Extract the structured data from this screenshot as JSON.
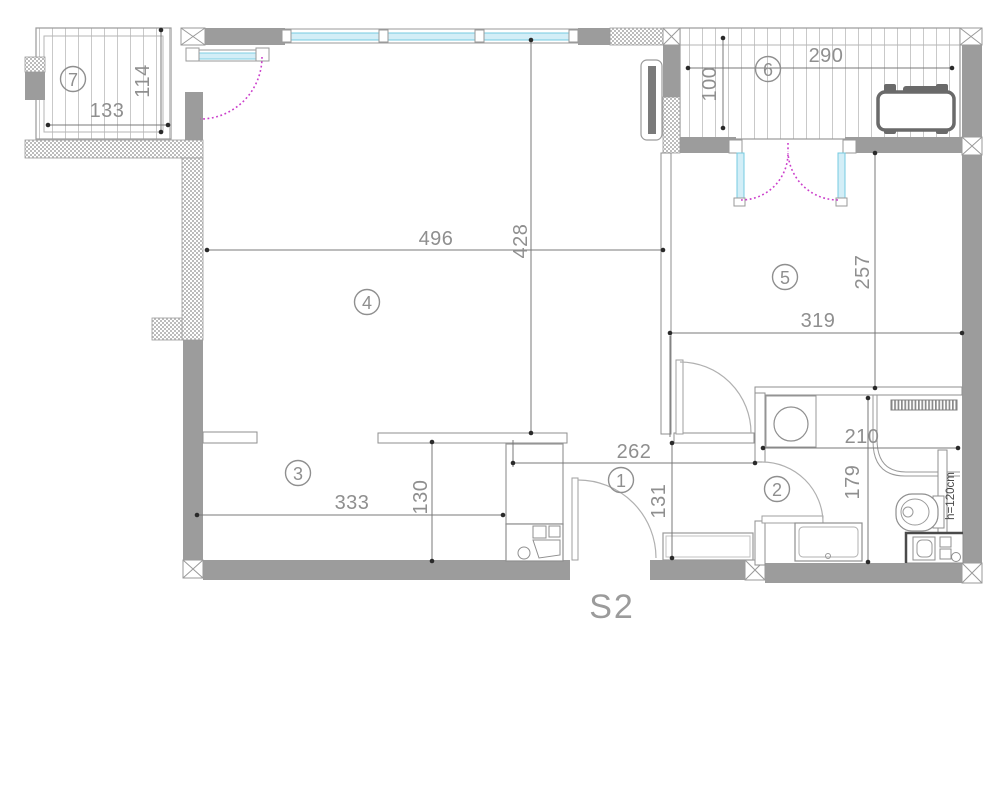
{
  "plan": {
    "title": "S2",
    "rooms": [
      {
        "label": "1"
      },
      {
        "label": "2"
      },
      {
        "label": "3"
      },
      {
        "label": "4"
      },
      {
        "label": "5"
      },
      {
        "label": "6"
      },
      {
        "label": "7"
      }
    ],
    "dimensions": {
      "balcony_left_width": "133",
      "balcony_left_depth": "114",
      "living_width": "496",
      "living_depth": "428",
      "balcony_right_width": "290",
      "balcony_right_depth": "100",
      "bedroom_depth": "257",
      "bedroom_width": "319",
      "dining_width": "333",
      "kitchen_nook_depth": "130",
      "hall_width": "262",
      "hall_depth": "131",
      "bathroom_width": "210",
      "bathroom_depth": "179"
    },
    "annotations": {
      "partition_height": "h=120cm"
    },
    "colors": {
      "wall": "#9c9c9c",
      "hatch": "#bcbcbc",
      "window_glass": "#d3eef7",
      "window_frame": "#74cbe0",
      "balcony_door_swing": "#cb3fcb",
      "interior_door_swing": "#b0b0b0",
      "dimension_text": "#8f8f8f",
      "dimension_line": "#787878",
      "fixture_line": "#8f8f8f"
    }
  }
}
